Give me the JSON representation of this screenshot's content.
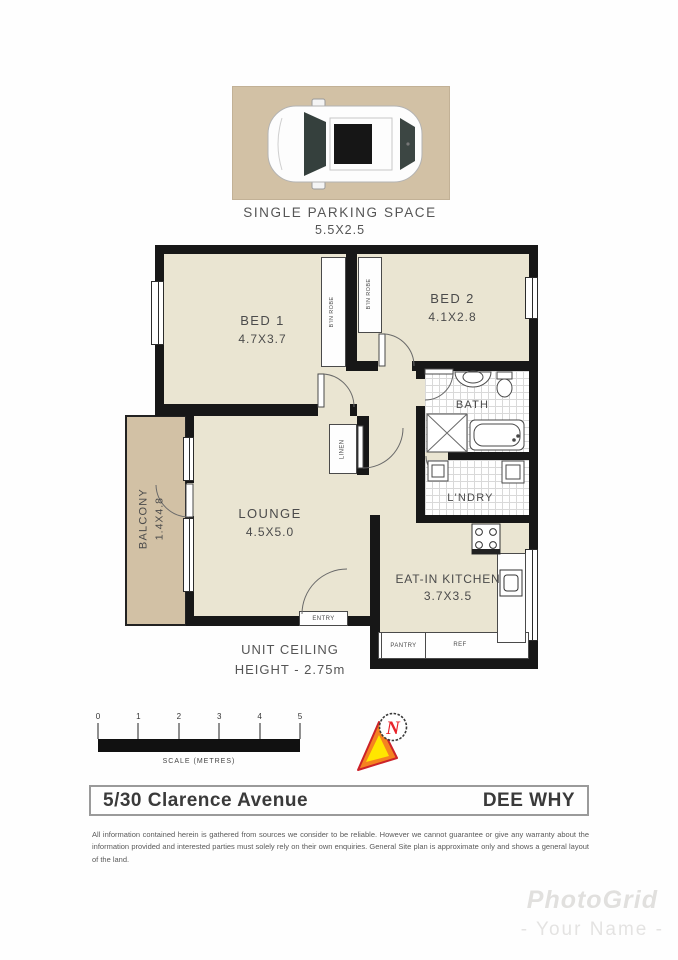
{
  "parking": {
    "label": "SINGLE PARKING SPACE",
    "size": "5.5X2.5"
  },
  "rooms": {
    "bed1": {
      "name": "BED 1",
      "size": "4.7X3.7"
    },
    "bed2": {
      "name": "BED 2",
      "size": "4.1X2.8"
    },
    "lounge": {
      "name": "LOUNGE",
      "size": "4.5X5.0"
    },
    "kitchen": {
      "name": "EAT-IN KITCHEN",
      "size": "3.7X3.5"
    },
    "bath": {
      "name": "BATH"
    },
    "laundry": {
      "name": "L'NDRY"
    },
    "balcony": {
      "name": "BALCONY",
      "size": "1.4X4.8"
    }
  },
  "features": {
    "robe1": "B'IN ROBE",
    "robe2": "B'IN ROBE",
    "linen": "LINEN",
    "pantry": "PANTRY",
    "fridge": "REF",
    "entry": "ENTRY"
  },
  "notes": {
    "ceiling_line1": "UNIT CEILING",
    "ceiling_line2": "HEIGHT - 2.75m"
  },
  "scale_bar": {
    "ticks": [
      "0",
      "1",
      "2",
      "3",
      "4",
      "5"
    ],
    "label": "SCALE (METRES)"
  },
  "compass": {
    "north_letter": "N"
  },
  "address_bar": {
    "street": "5/30 Clarence Avenue",
    "suburb": "DEE WHY"
  },
  "disclaimer": "All information contained herein is gathered from sources we consider to be reliable.  However we cannot guarantee or give any warranty about the information provided and interested parties must solely rely on their own enquiries.  General Site plan is approximate only and shows a general layout of the land.",
  "watermark": {
    "brand": "PhotoGrid",
    "name": "- Your Name -"
  },
  "colors": {
    "floor": "#eae5d2",
    "deck": "#d2c1a5",
    "wall": "#171717",
    "label_text": "#4b4b4b"
  }
}
